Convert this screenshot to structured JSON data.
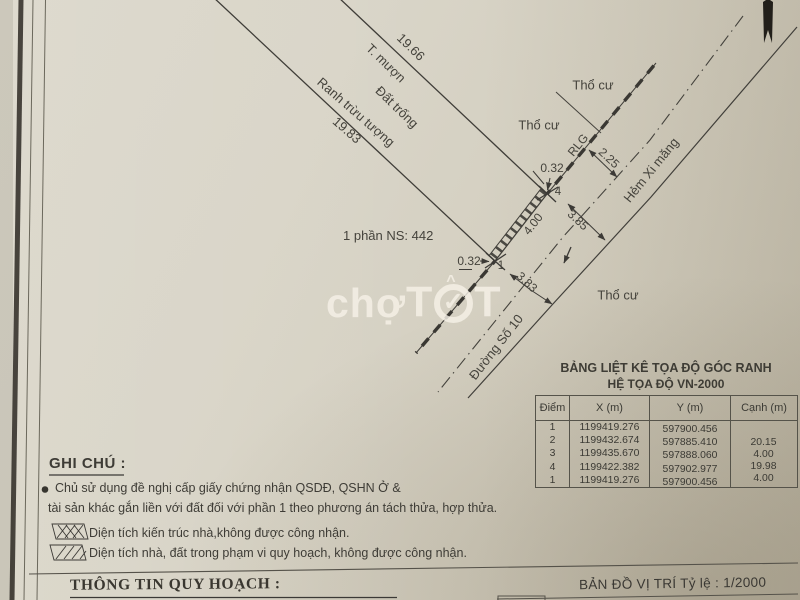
{
  "watermark": {
    "prefix": "chợ",
    "t1": "T",
    "check": "✓",
    "caret": "^",
    "t2": "T"
  },
  "drawing": {
    "labels": {
      "len_a": "19.66",
      "side_a": "T. mượn",
      "area": "Đất trống",
      "side_b": "Ranh trừu tượng",
      "len_b": "19.83",
      "tho_cu_1": "Thổ cư",
      "tho_cu_2": "Thổ cư",
      "tho_cu_3": "Thổ cư",
      "rlg": "RLG",
      "alley": "Hẻm Xi măng",
      "street": "Đường Số 10",
      "dim_225": "2.25",
      "dim_385": "3.85",
      "dim_383": "3.83",
      "dim_400": "4.00",
      "offset_top": "0.32",
      "offset_bottom": "0.32",
      "parcel": "1 phần NS: 442",
      "pt4": "4",
      "pt1": "1"
    }
  },
  "table": {
    "title1": "BẢNG LIỆT KÊ TỌA ĐỘ GÓC RANH",
    "title2": "HỆ TỌA ĐỘ VN-2000",
    "headers": [
      "Điểm",
      "X (m)",
      "Y (m)",
      "Cạnh (m)"
    ],
    "rows": [
      [
        "1",
        "1199419.276",
        "597900.456"
      ],
      [
        "2",
        "1199432.674",
        "597885.410"
      ],
      [
        "3",
        "1199435.670",
        "597888.060"
      ],
      [
        "4",
        "1199422.382",
        "597902.977"
      ],
      [
        "1",
        "1199419.276",
        "597900.456"
      ]
    ],
    "edge_values": [
      "20.15",
      "4.00",
      "19.98",
      "4.00"
    ]
  },
  "notes": {
    "heading": "GHI CHÚ :",
    "bullet_line1": "Chủ sử dụng đề nghị cấp giấy chứng nhận QSDĐ, QSHN Ở &",
    "bullet_line2": "tài sản khác gắn liền với đất đối với phần 1 theo phương án tách thửa, hợp thửa.",
    "legend1": "Diện tích kiến trúc nhà,không được công nhận.",
    "legend2": "Diện tích nhà, đất trong phạm vi quy hoạch, không được công nhận."
  },
  "footer": {
    "left": "THÔNG TIN QUY HOẠCH :",
    "right": "BẢN ĐỒ VỊ TRÍ  Tỷ lệ  : 1/2000"
  },
  "colors": {
    "paper": "#d7d3c6",
    "ink": "#3c3a36",
    "watermark": "#f1ece2"
  }
}
